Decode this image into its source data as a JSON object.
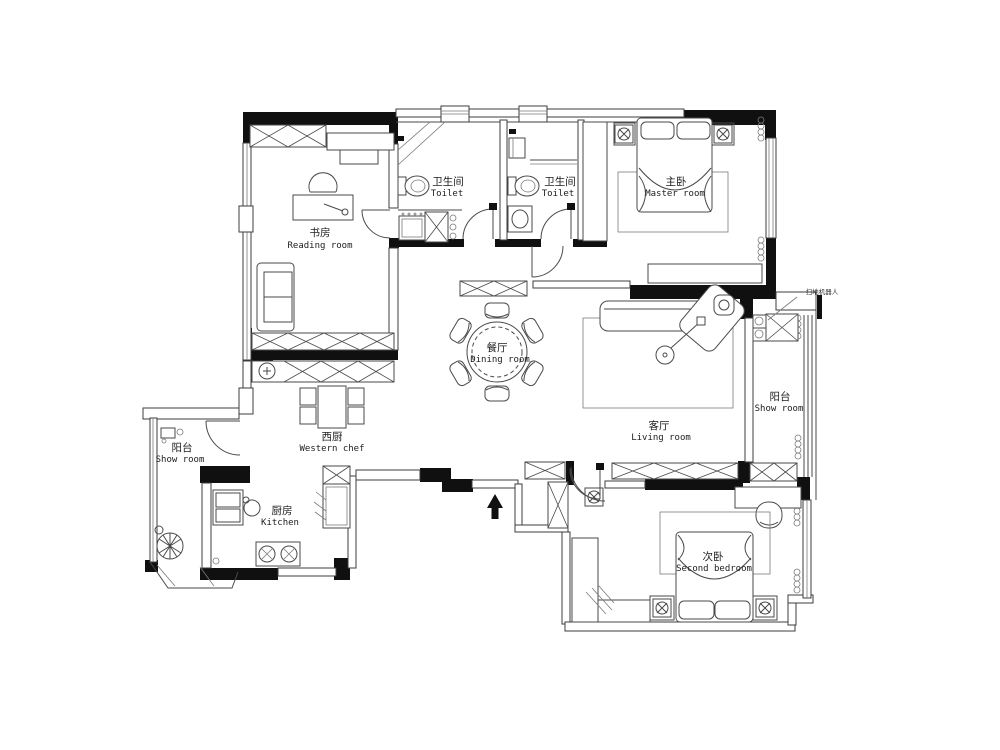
{
  "title": "apartment-floor-plan",
  "rooms": {
    "reading": {
      "zh": "书房",
      "en": "Reading room"
    },
    "toilet_a": {
      "zh": "卫生间",
      "en": "Toilet"
    },
    "toilet_b": {
      "zh": "卫生间",
      "en": "Toilet"
    },
    "master": {
      "zh": "主卧",
      "en": "Master room"
    },
    "dining": {
      "zh": "餐厅",
      "en": "Dining room"
    },
    "living": {
      "zh": "客厅",
      "en": "Living room"
    },
    "balcony_right": {
      "zh": "阳台",
      "en": "Show room"
    },
    "balcony_left": {
      "zh": "阳台",
      "en": "Show room"
    },
    "western_kitchen": {
      "zh": "西厨",
      "en": "Western chef"
    },
    "kitchen": {
      "zh": "厨房",
      "en": "Kitchen"
    },
    "second_bedroom": {
      "zh": "次卧",
      "en": "Second bedroom"
    }
  },
  "annotations": {
    "robot_vacuum": "扫地机器人"
  },
  "colors": {
    "wall": "#101010",
    "line": "#4a4a4a",
    "background": "#ffffff"
  }
}
